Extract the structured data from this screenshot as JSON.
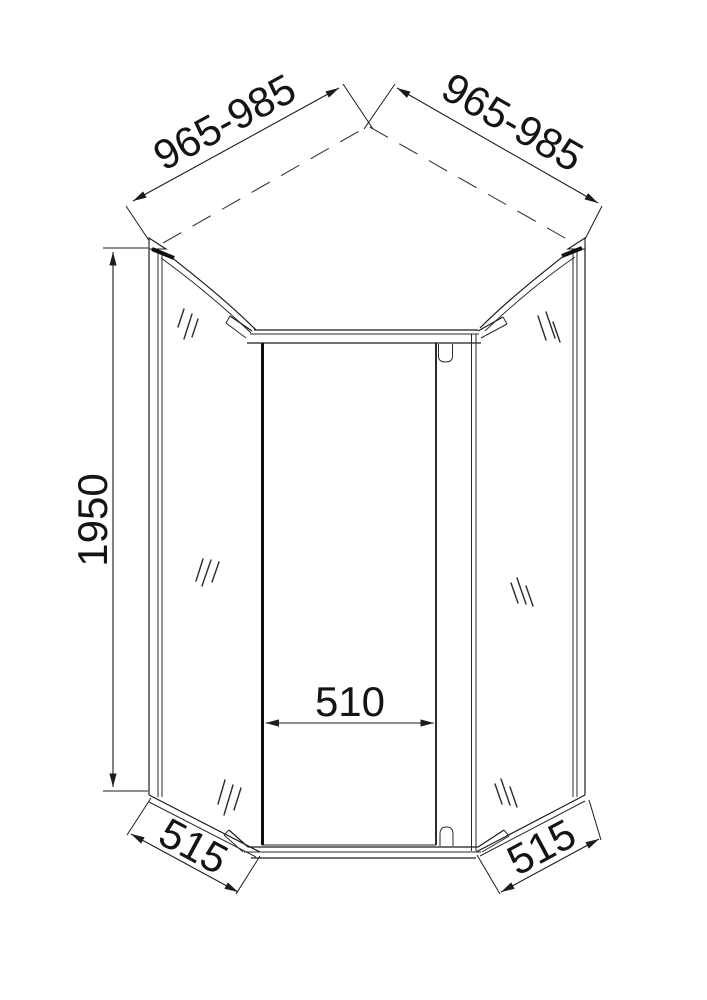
{
  "drawing": {
    "background_color": "#ffffff",
    "line_color": "#1c1c1c",
    "dimensions": {
      "top_left_width": "965-985",
      "top_right_width": "965-985",
      "height": "1950",
      "door_width": "510",
      "bottom_left_side": "515",
      "bottom_right_side": "515"
    }
  }
}
